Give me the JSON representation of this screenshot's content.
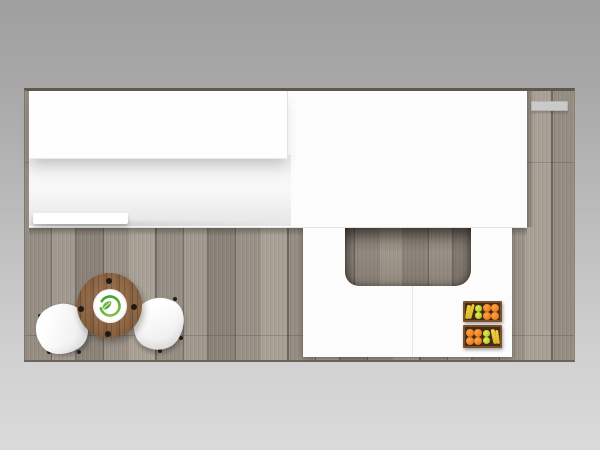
{
  "scene": {
    "type": "trade-show-booth-top-view",
    "description": "Top-down 3D rendering of a rectangular exhibit booth: gray wood-plank flooring, white overhead canopy panels along the back, a U-shaped white reception counter with a rounded floor cutout, two wooden produce crates with oranges, apples and bananas, and a round wooden cafe table with a green eco-leaf logo flanked by two white molded chairs."
  },
  "palette": {
    "background_top": "#9f9f9f",
    "background_bottom": "#dadada",
    "floor_base": "#8f867c",
    "floor_dark_plank": "#71685f",
    "floor_light_plank": "#aaa196",
    "panel_white": "#fcfcfc",
    "counter_white": "#fcfcfc",
    "table_wood": "#8a5f3d",
    "logo_green_light": "#8cc63f",
    "logo_green_dark": "#2f9e2f",
    "crate_brown": "#462b16",
    "crate_rim": "#7a5129",
    "fruit_orange": "#ef8120",
    "fruit_apple_green": "#bdd331",
    "fruit_banana_yellow": "#e8c535",
    "shelf_gray": "#cacaca"
  },
  "objects": {
    "floor": {
      "label": "wood plank booth floor"
    },
    "canopy_slab": {
      "label": "large white overhead canopy panel"
    },
    "canopy_panel": {
      "label": "raised white canopy panel (back left)"
    },
    "ledge": {
      "label": "low white shelf ledge"
    },
    "wall_shelf": {
      "label": "gray wall-mounted shelf tab"
    },
    "counter": {
      "label": "U-shaped white reception counter"
    },
    "counter_cutout": {
      "label": "floor cutout inside counter"
    },
    "crate_top": {
      "label": "produce crate with bananas, apples and oranges"
    },
    "crate_bottom": {
      "label": "produce crate with oranges, apples and bananas"
    },
    "table": {
      "label": "round wooden cafe table"
    },
    "table_logo": {
      "label": "green eco leaf logo"
    },
    "chair_left": {
      "label": "white molded chair (left)"
    },
    "chair_right": {
      "label": "white molded chair (right)"
    }
  }
}
